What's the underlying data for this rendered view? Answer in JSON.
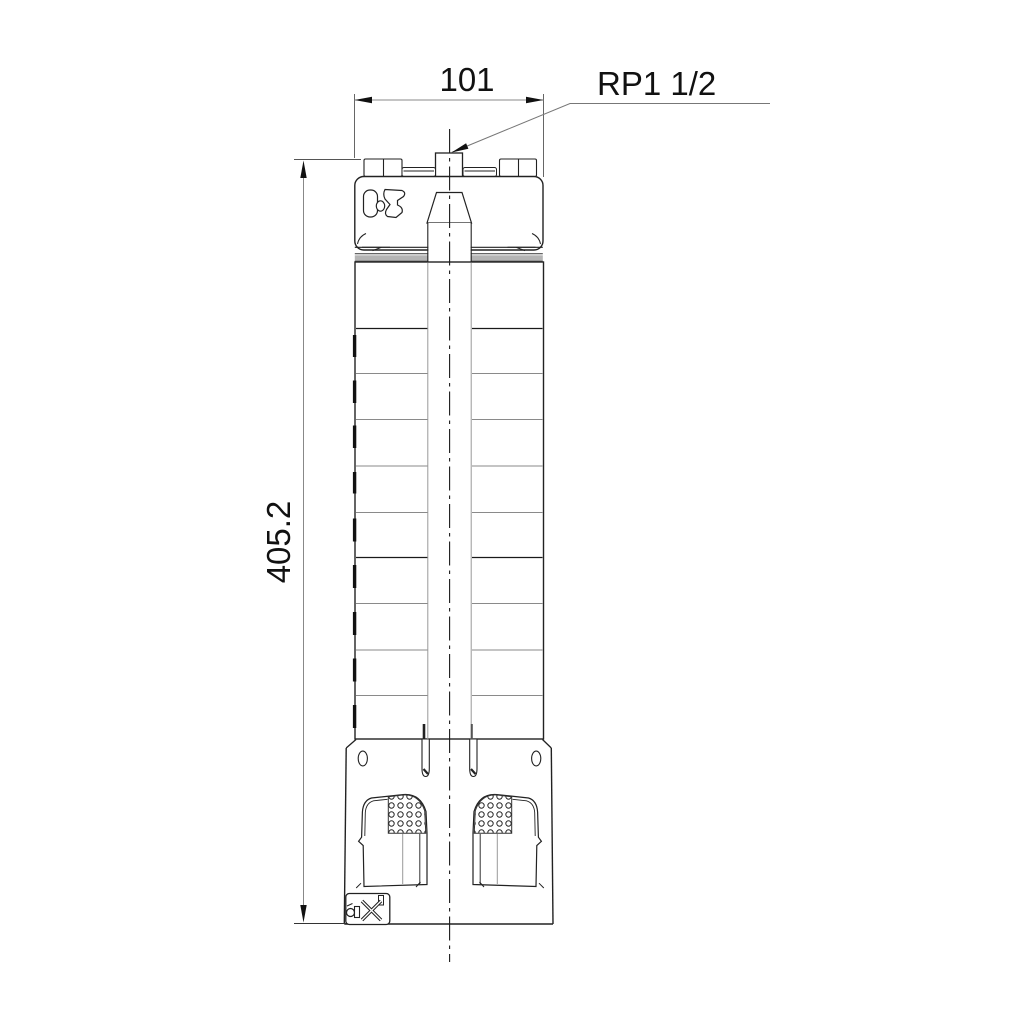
{
  "labels": {
    "width_dimension": "101",
    "height_dimension": "405.2",
    "connection": "RP1 1/2"
  },
  "colors": {
    "background": "#ffffff",
    "outline": "#1f1f1f",
    "secondary_line": "#8a8a8a",
    "dimension_line": "#888888",
    "band_fill": "#b4b4b4"
  }
}
